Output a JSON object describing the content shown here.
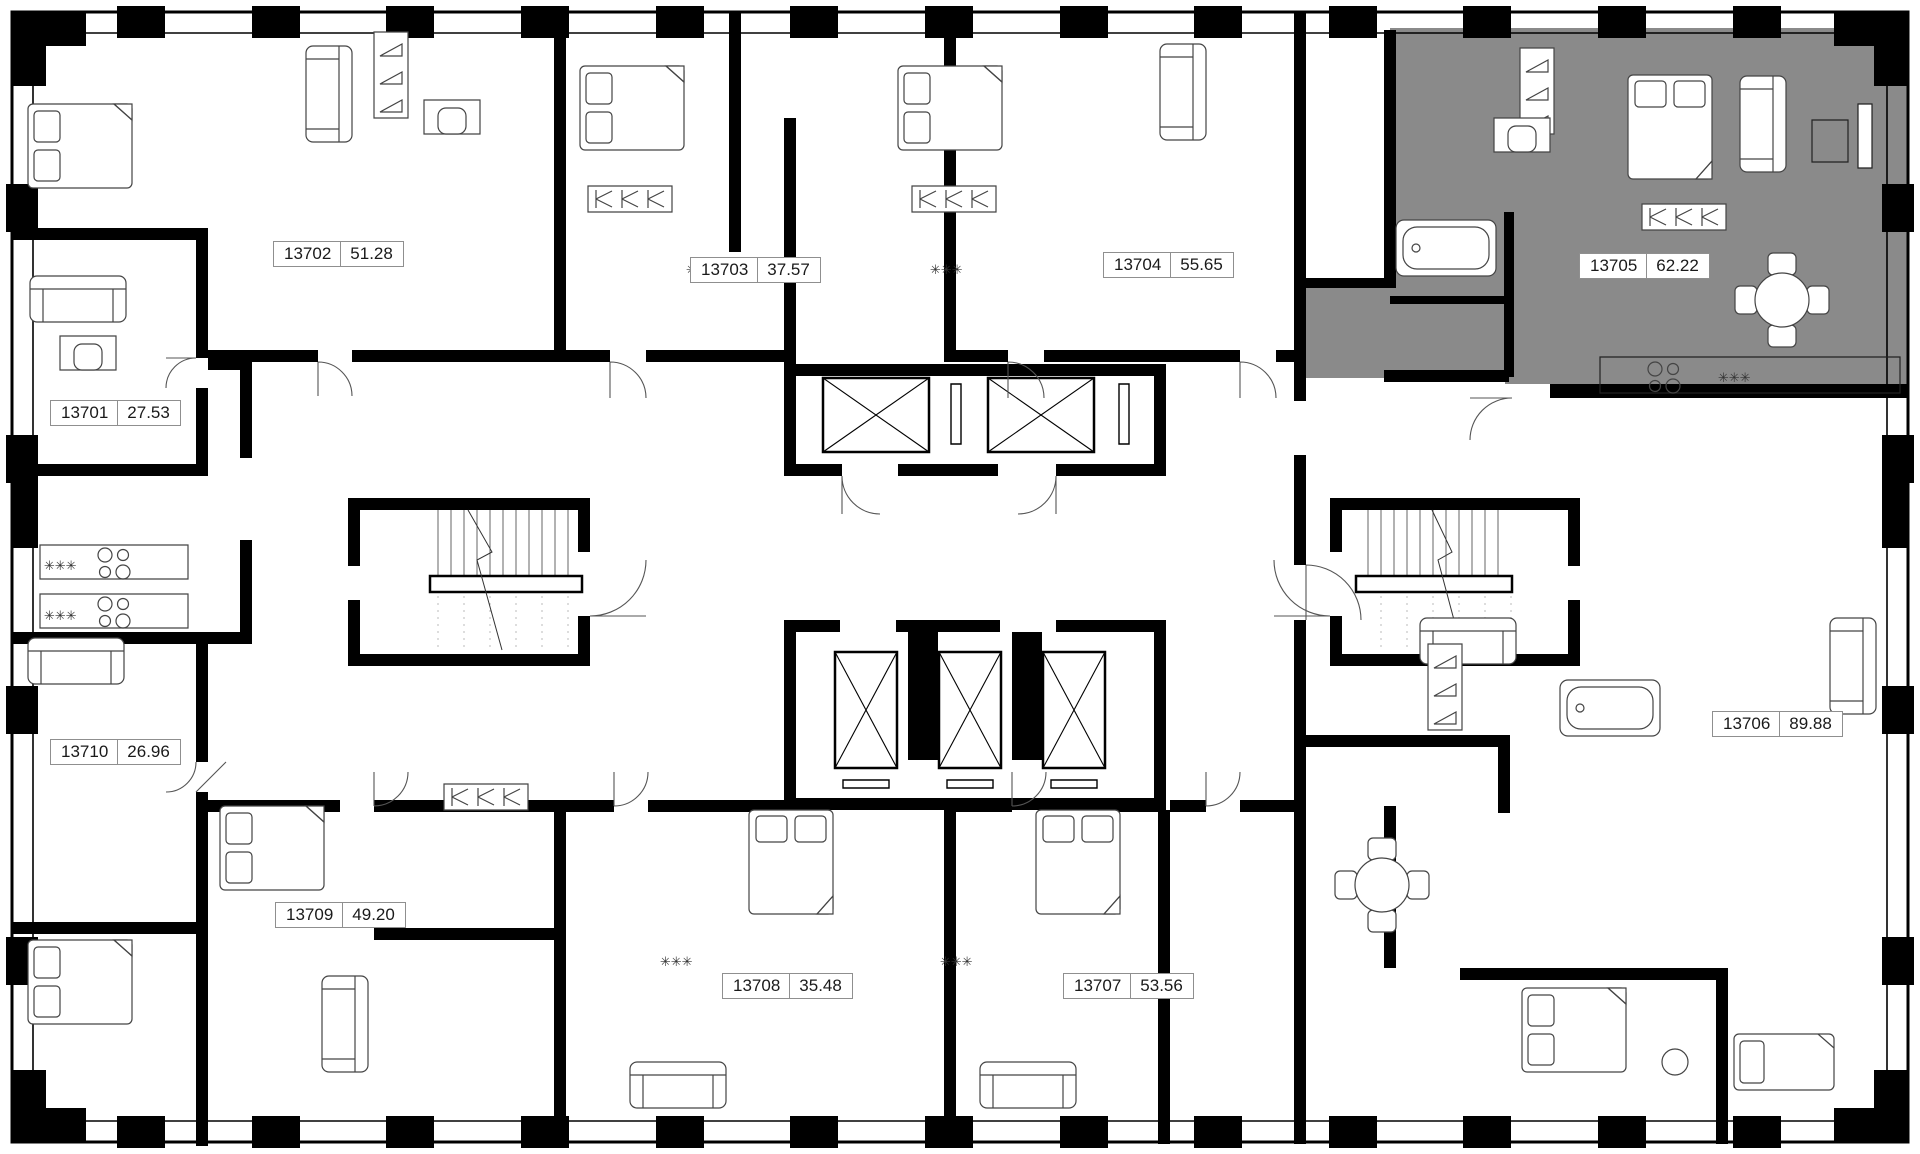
{
  "plan": {
    "floor_plan_type": "residential-floor-plan",
    "wall_color": "#000000",
    "background_color": "#ffffff",
    "highlight_color": "#8a8a8a",
    "hob_symbol": "✳✳✳",
    "selected_apartment": {
      "number": "13705",
      "area": "62.22"
    },
    "apartments": [
      {
        "number": "13701",
        "area": "27.53",
        "selected": false
      },
      {
        "number": "13702",
        "area": "51.28",
        "selected": false
      },
      {
        "number": "13703",
        "area": "37.57",
        "selected": false
      },
      {
        "number": "13704",
        "area": "55.65",
        "selected": false
      },
      {
        "number": "13705",
        "area": "62.22",
        "selected": true
      },
      {
        "number": "13706",
        "area": "89.88",
        "selected": false
      },
      {
        "number": "13707",
        "area": "53.56",
        "selected": false
      },
      {
        "number": "13708",
        "area": "35.48",
        "selected": false
      },
      {
        "number": "13709",
        "area": "49.20",
        "selected": false
      },
      {
        "number": "13710",
        "area": "26.96",
        "selected": false
      }
    ]
  }
}
